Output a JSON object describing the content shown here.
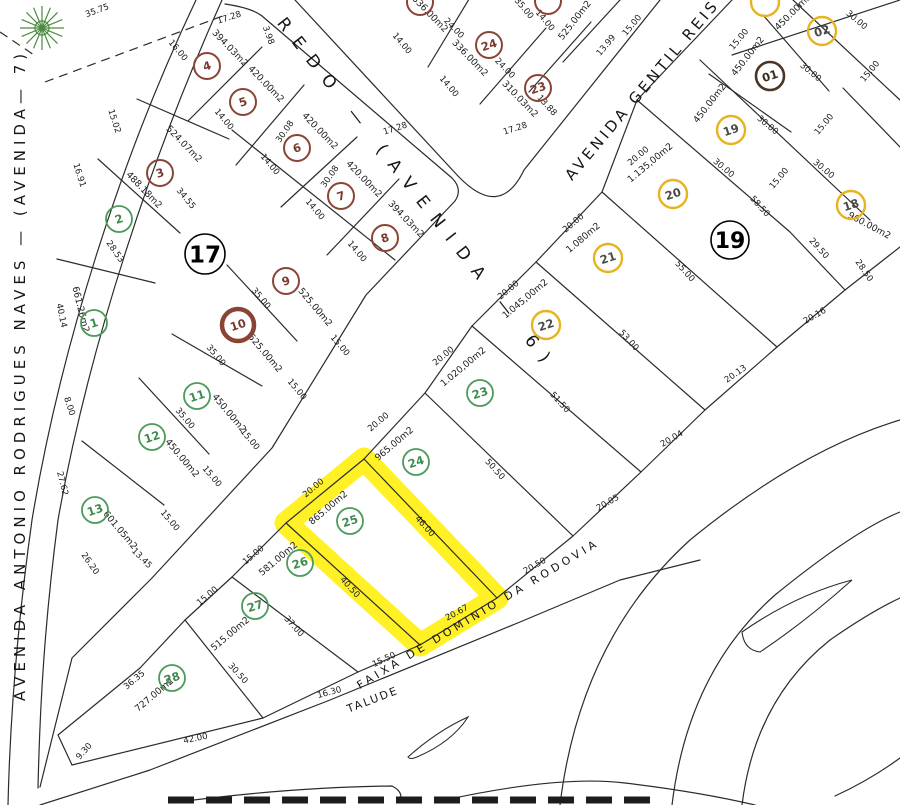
{
  "map": {
    "colors": {
      "ink": "#2b2b2b",
      "brown_circle": "#8a4435",
      "brown_text": "#7a3a2c",
      "green_circle": "#4c9a5c",
      "green_text": "#3f8a4f",
      "yellow_circle": "#e8b321",
      "yellow_text": "#4a4a4a",
      "dark_circle": "#4a3626",
      "dark_text": "#3a2a1a",
      "highlight": "#ffee00",
      "tree": "#4a8a3f",
      "background": "#ffffff"
    },
    "streets": [
      {
        "id": "avenida-7",
        "label": "AVENIDA ANTONIO RODRIGUES NAVES  —  (AVENIDA— 7)",
        "x": 25,
        "y": 375,
        "rot": -90,
        "size": 15,
        "ls": 5
      },
      {
        "id": "avenida-6",
        "label": "REDO  —  (AVENIDA  —  6)",
        "x": 413,
        "y": 198,
        "rot": 52,
        "size": 17,
        "ls": 12
      },
      {
        "id": "avenida-gentil-reis",
        "label": "AVENIDA  GENTIL  REIS",
        "x": 646,
        "y": 93,
        "rot": -50,
        "size": 15,
        "ls": 3.5
      },
      {
        "id": "faixa-dominio",
        "label": "FAIXA  DE  DOMINIO  DA  RODOVIA",
        "x": 480,
        "y": 617,
        "rot": -31,
        "size": 11,
        "ls": 3.8
      },
      {
        "id": "talude",
        "label": "TALUDE",
        "x": 374,
        "y": 703,
        "rot": -21,
        "size": 11,
        "ls": 2
      }
    ],
    "blocks": [
      {
        "label": "17",
        "x": 205,
        "y": 254,
        "r": 20,
        "font": 23
      },
      {
        "label": "19",
        "x": 730,
        "y": 240,
        "r": 19,
        "font": 22
      }
    ],
    "lots": [
      {
        "n": "1",
        "x": 94,
        "y": 323,
        "c": "green"
      },
      {
        "n": "2",
        "x": 119,
        "y": 219,
        "c": "green"
      },
      {
        "n": "3",
        "x": 160,
        "y": 173,
        "c": "brown"
      },
      {
        "n": "4",
        "x": 207,
        "y": 66,
        "c": "brown"
      },
      {
        "n": "5",
        "x": 243,
        "y": 102,
        "c": "brown"
      },
      {
        "n": "6",
        "x": 297,
        "y": 148,
        "c": "brown"
      },
      {
        "n": "7",
        "x": 341,
        "y": 196,
        "c": "brown"
      },
      {
        "n": "8",
        "x": 385,
        "y": 238,
        "c": "brown"
      },
      {
        "n": "9",
        "x": 286,
        "y": 281,
        "c": "brown"
      },
      {
        "n": "10",
        "x": 238,
        "y": 325,
        "c": "brown-thick"
      },
      {
        "n": "11",
        "x": 197,
        "y": 396,
        "c": "green"
      },
      {
        "n": "12",
        "x": 152,
        "y": 437,
        "c": "green"
      },
      {
        "n": "13",
        "x": 95,
        "y": 510,
        "c": "green"
      },
      {
        "n": "23",
        "x": 480,
        "y": 393,
        "c": "green"
      },
      {
        "n": "24",
        "x": 416,
        "y": 462,
        "c": "green"
      },
      {
        "n": "25",
        "x": 350,
        "y": 521,
        "c": "green"
      },
      {
        "n": "26",
        "x": 300,
        "y": 563,
        "c": "green"
      },
      {
        "n": "27",
        "x": 255,
        "y": 606,
        "c": "green"
      },
      {
        "n": "28",
        "x": 172,
        "y": 678,
        "c": "green"
      },
      {
        "n": "18",
        "x": 851,
        "y": 205,
        "c": "yellow"
      },
      {
        "n": "19",
        "x": 731,
        "y": 130,
        "c": "yellow"
      },
      {
        "n": "20",
        "x": 673,
        "y": 194,
        "c": "yellow"
      },
      {
        "n": "21",
        "x": 608,
        "y": 258,
        "c": "yellow"
      },
      {
        "n": "22",
        "x": 546,
        "y": 325,
        "c": "yellow"
      },
      {
        "n": "02",
        "x": 822,
        "y": 31,
        "c": "yellow"
      },
      {
        "n": "01",
        "x": 770,
        "y": 76,
        "c": "dark"
      },
      {
        "n": "24",
        "x": 489,
        "y": 45,
        "c": "brown"
      },
      {
        "n": "23",
        "x": 538,
        "y": 88,
        "c": "brown"
      },
      {
        "n": "",
        "x": 420,
        "y": 2,
        "c": "brown"
      },
      {
        "n": "",
        "x": 548,
        "y": 1,
        "c": "brown"
      },
      {
        "n": "",
        "x": 765,
        "y": 2,
        "c": "yellow"
      }
    ],
    "areas": [
      {
        "t": "394.03m2",
        "x": 228,
        "y": 50,
        "r": 46
      },
      {
        "t": "420.00m2",
        "x": 264,
        "y": 86,
        "r": 46
      },
      {
        "t": "420.00m2",
        "x": 318,
        "y": 133,
        "r": 46
      },
      {
        "t": "420.00m2",
        "x": 362,
        "y": 181,
        "r": 46
      },
      {
        "t": "394.03m2",
        "x": 404,
        "y": 221,
        "r": 46
      },
      {
        "t": "524.07m2",
        "x": 182,
        "y": 146,
        "r": 46
      },
      {
        "t": "488.18m2",
        "x": 142,
        "y": 192,
        "r": 46
      },
      {
        "t": "661.26m2",
        "x": 78,
        "y": 310,
        "r": 76
      },
      {
        "t": "525.00m2",
        "x": 313,
        "y": 309,
        "r": 50
      },
      {
        "t": "525.00m2",
        "x": 263,
        "y": 355,
        "r": 50
      },
      {
        "t": "450.00m2",
        "x": 227,
        "y": 415,
        "r": 50
      },
      {
        "t": "450.00m2",
        "x": 180,
        "y": 460,
        "r": 50
      },
      {
        "t": "601.05m2",
        "x": 118,
        "y": 532,
        "r": 50
      },
      {
        "t": "336.00m2",
        "x": 428,
        "y": 16,
        "r": 46
      },
      {
        "t": "336.00m2",
        "x": 468,
        "y": 60,
        "r": 46
      },
      {
        "t": "310.03m2",
        "x": 518,
        "y": 101,
        "r": 46
      },
      {
        "t": "525.00m2",
        "x": 577,
        "y": 22,
        "r": -52
      },
      {
        "t": "450.00m2",
        "x": 795,
        "y": 14,
        "r": -45
      },
      {
        "t": "450.00m2",
        "x": 750,
        "y": 58,
        "r": -52
      },
      {
        "t": "450.00m2",
        "x": 712,
        "y": 105,
        "r": -52
      },
      {
        "t": "960.00m2",
        "x": 868,
        "y": 228,
        "r": 28
      },
      {
        "t": "1.135,00m2",
        "x": 652,
        "y": 165,
        "r": -40
      },
      {
        "t": "1.080m2",
        "x": 585,
        "y": 240,
        "r": -40
      },
      {
        "t": "1.045,00m2",
        "x": 527,
        "y": 301,
        "r": -40
      },
      {
        "t": "1.020,00m2",
        "x": 465,
        "y": 369,
        "r": -40
      },
      {
        "t": "965.00m2",
        "x": 396,
        "y": 446,
        "r": -40
      },
      {
        "t": "865.00m2",
        "x": 330,
        "y": 510,
        "r": -40
      },
      {
        "t": "581.00m2",
        "x": 280,
        "y": 561,
        "r": -40
      },
      {
        "t": "515.00m2",
        "x": 232,
        "y": 636,
        "r": -40
      },
      {
        "t": "727.00m2",
        "x": 156,
        "y": 697,
        "r": -40
      }
    ],
    "dims": [
      {
        "t": "35.75",
        "x": 98,
        "y": 13,
        "r": -20
      },
      {
        "t": "17.28",
        "x": 230,
        "y": 20,
        "r": -18
      },
      {
        "t": "3.98",
        "x": 266,
        "y": 36,
        "r": 70
      },
      {
        "t": "16.00",
        "x": 176,
        "y": 52,
        "r": 50
      },
      {
        "t": "14.00",
        "x": 222,
        "y": 121,
        "r": 50
      },
      {
        "t": "14.00",
        "x": 268,
        "y": 166,
        "r": 50
      },
      {
        "t": "14.00",
        "x": 313,
        "y": 211,
        "r": 50
      },
      {
        "t": "14.00",
        "x": 355,
        "y": 253,
        "r": 50
      },
      {
        "t": "15.02",
        "x": 112,
        "y": 122,
        "r": 72
      },
      {
        "t": "16.91",
        "x": 77,
        "y": 176,
        "r": 72
      },
      {
        "t": "28.53",
        "x": 113,
        "y": 253,
        "r": 55
      },
      {
        "t": "34.55",
        "x": 184,
        "y": 200,
        "r": 50
      },
      {
        "t": "30.08",
        "x": 287,
        "y": 133,
        "r": -55
      },
      {
        "t": "30.08",
        "x": 332,
        "y": 178,
        "r": -55
      },
      {
        "t": "40.14",
        "x": 59,
        "y": 316,
        "r": 78
      },
      {
        "t": "8.00",
        "x": 67,
        "y": 407,
        "r": 72
      },
      {
        "t": "27.62",
        "x": 60,
        "y": 484,
        "r": 76
      },
      {
        "t": "35.00",
        "x": 259,
        "y": 300,
        "r": 50
      },
      {
        "t": "35.00",
        "x": 214,
        "y": 357,
        "r": 50
      },
      {
        "t": "35.00",
        "x": 183,
        "y": 420,
        "r": 50
      },
      {
        "t": "15.00",
        "x": 338,
        "y": 347,
        "r": 50
      },
      {
        "t": "15.00",
        "x": 295,
        "y": 391,
        "r": 50
      },
      {
        "t": "15.00",
        "x": 248,
        "y": 441,
        "r": 50
      },
      {
        "t": "15.00",
        "x": 210,
        "y": 478,
        "r": 50
      },
      {
        "t": "15.00",
        "x": 168,
        "y": 522,
        "r": 50
      },
      {
        "t": "13.45",
        "x": 140,
        "y": 560,
        "r": 45
      },
      {
        "t": "26.20",
        "x": 88,
        "y": 565,
        "r": 55
      },
      {
        "t": "36.35",
        "x": 136,
        "y": 682,
        "r": -40
      },
      {
        "t": "9.30",
        "x": 86,
        "y": 753,
        "r": -48
      },
      {
        "t": "42.00",
        "x": 196,
        "y": 741,
        "r": -12
      },
      {
        "t": "16.30",
        "x": 330,
        "y": 695,
        "r": -15
      },
      {
        "t": "15.50",
        "x": 385,
        "y": 662,
        "r": -25
      },
      {
        "t": "20.67",
        "x": 458,
        "y": 615,
        "r": -28
      },
      {
        "t": "20.50",
        "x": 536,
        "y": 568,
        "r": -30
      },
      {
        "t": "20.05",
        "x": 609,
        "y": 505,
        "r": -30
      },
      {
        "t": "20.04",
        "x": 673,
        "y": 441,
        "r": -30
      },
      {
        "t": "20.13",
        "x": 737,
        "y": 376,
        "r": -35
      },
      {
        "t": "20.16",
        "x": 816,
        "y": 318,
        "r": -30
      },
      {
        "t": "40.50",
        "x": 348,
        "y": 589,
        "r": 48
      },
      {
        "t": "37.00",
        "x": 292,
        "y": 628,
        "r": 48
      },
      {
        "t": "30.50",
        "x": 236,
        "y": 675,
        "r": 48
      },
      {
        "t": "46.00",
        "x": 423,
        "y": 528,
        "r": 48
      },
      {
        "t": "50.50",
        "x": 493,
        "y": 471,
        "r": 48
      },
      {
        "t": "51.50",
        "x": 558,
        "y": 404,
        "r": 48
      },
      {
        "t": "53.00",
        "x": 627,
        "y": 342,
        "r": 48
      },
      {
        "t": "55.00",
        "x": 683,
        "y": 273,
        "r": 48
      },
      {
        "t": "58.50",
        "x": 758,
        "y": 208,
        "r": 48
      },
      {
        "t": "29.50",
        "x": 817,
        "y": 250,
        "r": 48
      },
      {
        "t": "28.50",
        "x": 862,
        "y": 272,
        "r": 55
      },
      {
        "t": "20.00",
        "x": 640,
        "y": 158,
        "r": -40
      },
      {
        "t": "20.00",
        "x": 575,
        "y": 225,
        "r": -40
      },
      {
        "t": "20.00",
        "x": 510,
        "y": 292,
        "r": -40
      },
      {
        "t": "20.00",
        "x": 445,
        "y": 358,
        "r": -40
      },
      {
        "t": "20.00",
        "x": 380,
        "y": 424,
        "r": -40
      },
      {
        "t": "20.00",
        "x": 315,
        "y": 490,
        "r": -40
      },
      {
        "t": "15.00",
        "x": 255,
        "y": 557,
        "r": -40
      },
      {
        "t": "15.00",
        "x": 209,
        "y": 598,
        "r": -40
      },
      {
        "t": "15.00",
        "x": 741,
        "y": 41,
        "r": -50
      },
      {
        "t": "15.00",
        "x": 872,
        "y": 73,
        "r": -50
      },
      {
        "t": "15.00",
        "x": 826,
        "y": 126,
        "r": -50
      },
      {
        "t": "15.00",
        "x": 781,
        "y": 180,
        "r": -50
      },
      {
        "t": "30.00",
        "x": 855,
        "y": 22,
        "r": 40
      },
      {
        "t": "30.00",
        "x": 809,
        "y": 74,
        "r": 40
      },
      {
        "t": "30.00",
        "x": 766,
        "y": 127,
        "r": 40
      },
      {
        "t": "30.00",
        "x": 722,
        "y": 170,
        "r": 40
      },
      {
        "t": "30.00",
        "x": 822,
        "y": 171,
        "r": 40
      },
      {
        "t": "14.00",
        "x": 400,
        "y": 45,
        "r": 50
      },
      {
        "t": "14.00",
        "x": 447,
        "y": 88,
        "r": 50
      },
      {
        "t": "24.00",
        "x": 452,
        "y": 30,
        "r": 46
      },
      {
        "t": "24.00",
        "x": 503,
        "y": 70,
        "r": 46
      },
      {
        "t": "13.88",
        "x": 545,
        "y": 107,
        "r": 48
      },
      {
        "t": "17.28",
        "x": 396,
        "y": 131,
        "r": -18
      },
      {
        "t": "17.28",
        "x": 516,
        "y": 131,
        "r": -18
      },
      {
        "t": "15.00",
        "x": 634,
        "y": 27,
        "r": -50
      },
      {
        "t": "13.99",
        "x": 608,
        "y": 47,
        "r": -50
      },
      {
        "t": "35.00",
        "x": 522,
        "y": 10,
        "r": 50
      },
      {
        "t": "14.00",
        "x": 543,
        "y": 22,
        "r": 50
      }
    ],
    "highlight_polygon": "364,459 497,598 420,645 286,523"
  }
}
